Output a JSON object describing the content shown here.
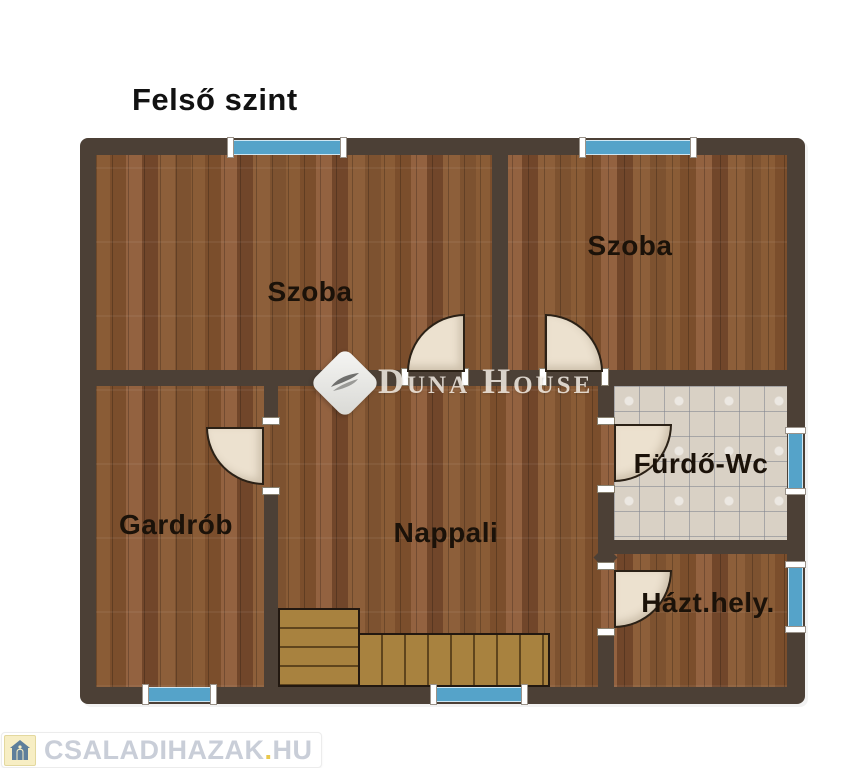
{
  "title": "Felső szint",
  "rooms": {
    "szoba_left": {
      "label": "Szoba"
    },
    "szoba_right": {
      "label": "Szoba"
    },
    "gardrob": {
      "label": "Gardrób"
    },
    "nappali": {
      "label": "Nappali"
    },
    "furdo_wc": {
      "label": "Fürdő-Wc"
    },
    "hazt_hely": {
      "label": "Házt.hely."
    }
  },
  "watermark": {
    "brand": "Duna House"
  },
  "footer_logo": {
    "site_name": "CSALADIHAZAK",
    "separator": ".",
    "tld": "HU"
  },
  "palette": {
    "wall": "#4c4036",
    "wood_floor": "#84552f",
    "stairs_wood": "#a8823f",
    "bathroom_tile": "#d9d1c5",
    "window_blue": "#55a3c9",
    "door_leaf": "#ece1cf",
    "label_text": "#1b1209",
    "footer_text": "#c9ced8",
    "footer_accent": "#e9c84d"
  }
}
